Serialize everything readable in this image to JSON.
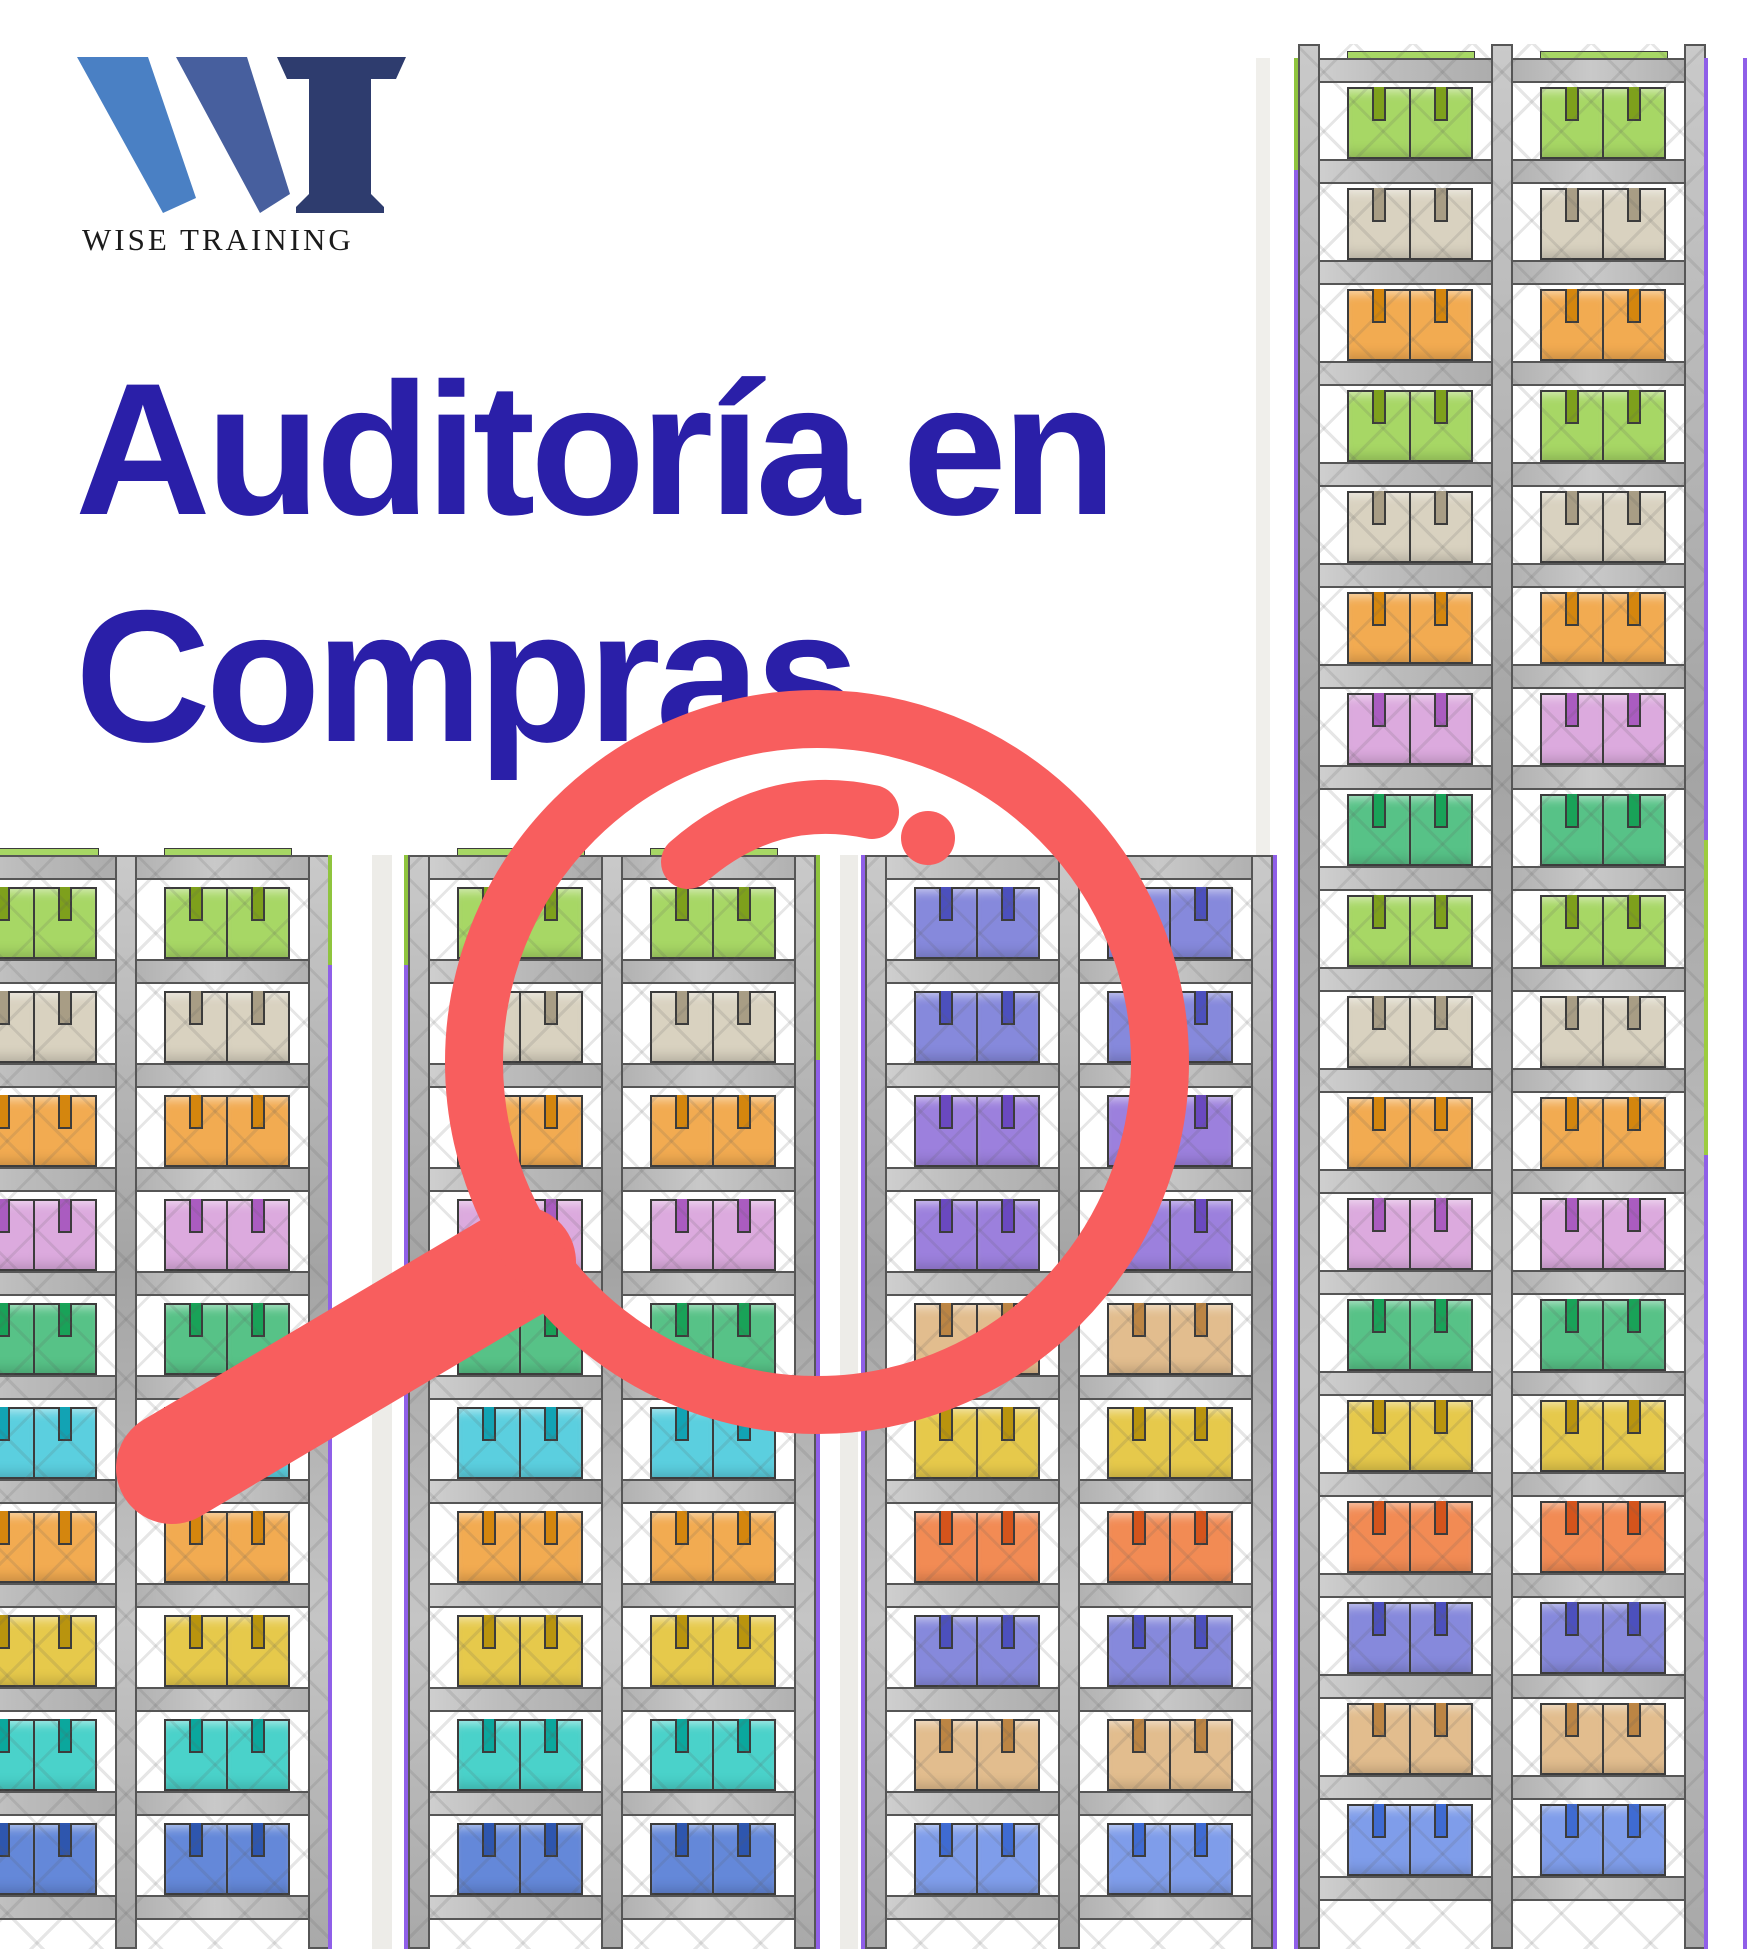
{
  "logo": {
    "brand": "WISE TRAINING",
    "colors": {
      "w1": "#4a80c4",
      "w2": "#475f9e",
      "t": "#2e3c6e",
      "text": "#1b1b1b"
    }
  },
  "title": {
    "line1": "Auditoría en",
    "line2": "Compras",
    "color": "#2a1fa8"
  },
  "palette": {
    "lightgreen": {
      "fill": "#a7d765",
      "strap": "#7ea01c"
    },
    "beige": {
      "fill": "#d9d2c0",
      "strap": "#a89d85"
    },
    "orange": {
      "fill": "#f2ab51",
      "strap": "#d4860e"
    },
    "lilac": {
      "fill": "#dcaade",
      "strap": "#aa5cc0"
    },
    "medgreen": {
      "fill": "#57c287",
      "strap": "#19a258"
    },
    "cyan": {
      "fill": "#5bcfdf",
      "strap": "#12a3b4"
    },
    "yellow": {
      "fill": "#e6c94b",
      "strap": "#b9940e"
    },
    "turquoise": {
      "fill": "#4ad2ca",
      "strap": "#0ba79d"
    },
    "blue": {
      "fill": "#6488d9",
      "strap": "#2e56ae"
    },
    "periwinkle": {
      "fill": "#8689dc",
      "strap": "#4c50bd"
    },
    "purple": {
      "fill": "#9c80dd",
      "strap": "#6a49c0"
    },
    "tan": {
      "fill": "#e2bd8e",
      "strap": "#bc8544"
    },
    "salmon": {
      "fill": "#f28b54",
      "strap": "#d4541c"
    },
    "lightblue": {
      "fill": "#7f9dea",
      "strap": "#3f6bd2"
    }
  },
  "rack_geometry": {
    "post_w": 22,
    "bay_w": 193,
    "bar_h": 25,
    "box_h": 72,
    "pair_w": 128,
    "pair_inset": 49
  },
  "racks": [
    {
      "id": "rack-left",
      "x": -78,
      "y": 855,
      "height": 1094,
      "bay_count": 2,
      "bar_count": 11,
      "pitch": 104,
      "bar_offset": 0,
      "top_sliver": "lightgreen",
      "rows": [
        "lightgreen",
        "beige",
        "orange",
        "lilac",
        "medgreen",
        "cyan",
        "orange",
        "yellow",
        "turquoise",
        "blue"
      ]
    },
    {
      "id": "rack-mid-left",
      "x": 408,
      "y": 855,
      "height": 1094,
      "bay_count": 2,
      "bar_count": 11,
      "pitch": 104,
      "bar_offset": 0,
      "top_sliver": "lightgreen",
      "rows": [
        "lightgreen",
        "beige",
        "orange",
        "lilac",
        "medgreen",
        "cyan",
        "orange",
        "yellow",
        "turquoise",
        "blue"
      ]
    },
    {
      "id": "rack-mid-right",
      "x": 865,
      "y": 855,
      "height": 1094,
      "bay_count": 2,
      "bar_count": 11,
      "pitch": 104,
      "bar_offset": 0,
      "top_sliver": null,
      "rows": [
        "periwinkle",
        "periwinkle",
        "purple",
        "purple",
        "tan",
        "yellow",
        "salmon",
        "periwinkle",
        "tan",
        "lightblue"
      ]
    },
    {
      "id": "rack-right-tall",
      "x": 1298,
      "y": 44,
      "height": 1905,
      "bay_count": 2,
      "bar_count": 19,
      "pitch": 101,
      "bar_offset": 14,
      "top_sliver": "lightgreen",
      "rows": [
        "lightgreen",
        "beige",
        "orange",
        "lightgreen",
        "beige",
        "orange",
        "lilac",
        "medgreen",
        "lightgreen",
        "beige",
        "orange",
        "lilac",
        "medgreen",
        "yellow",
        "salmon",
        "periwinkle",
        "tan",
        "lightblue"
      ]
    }
  ],
  "background_stripes": [
    {
      "x": 372,
      "y": 855,
      "w": 20,
      "h": 1094,
      "color": "#edece8"
    },
    {
      "x": 840,
      "y": 855,
      "w": 18,
      "h": 1094,
      "color": "#edece8"
    },
    {
      "x": 1256,
      "y": 58,
      "w": 14,
      "h": 1891,
      "color": "#f0efeb"
    }
  ],
  "edge_lines": [
    {
      "x": 328,
      "segments": [
        {
          "y1": 855,
          "y2": 965,
          "c": "#8fc43e"
        },
        {
          "y1": 965,
          "y2": 1949,
          "c": "#8f5fe8"
        }
      ]
    },
    {
      "x": 404,
      "segments": [
        {
          "y1": 855,
          "y2": 965,
          "c": "#8fc43e"
        },
        {
          "y1": 965,
          "y2": 1949,
          "c": "#8f5fe8"
        }
      ]
    },
    {
      "x": 816,
      "segments": [
        {
          "y1": 855,
          "y2": 1060,
          "c": "#8fc43e"
        },
        {
          "y1": 1060,
          "y2": 1949,
          "c": "#8f5fe8"
        }
      ]
    },
    {
      "x": 861,
      "segments": [
        {
          "y1": 855,
          "y2": 1949,
          "c": "#8f5fe8"
        }
      ]
    },
    {
      "x": 1273,
      "segments": [
        {
          "y1": 855,
          "y2": 1949,
          "c": "#8f5fe8"
        }
      ]
    },
    {
      "x": 1294,
      "segments": [
        {
          "y1": 58,
          "y2": 170,
          "c": "#8fc43e"
        },
        {
          "y1": 170,
          "y2": 1949,
          "c": "#8f5fe8"
        }
      ]
    },
    {
      "x": 1704,
      "segments": [
        {
          "y1": 58,
          "y2": 840,
          "c": "#8f5fe8"
        },
        {
          "y1": 840,
          "y2": 1155,
          "c": "#9ccc3f"
        },
        {
          "y1": 1155,
          "y2": 1949,
          "c": "#8f5fe8"
        }
      ]
    },
    {
      "x": 1743,
      "segments": [
        {
          "y1": 58,
          "y2": 1949,
          "c": "#8f5fe8"
        }
      ]
    }
  ],
  "magnifier": {
    "color": "#f85e5e",
    "ring": {
      "cx": 817,
      "cy": 1062,
      "r": 343,
      "stroke": 58
    },
    "handle": {
      "x1": 520,
      "y1": 1262,
      "x2": 172,
      "y2": 1468,
      "stroke": 112
    },
    "shine": {
      "d": "M 688 862 Q 770 790 872 812",
      "stroke": 54
    },
    "dot": {
      "cx": 928,
      "cy": 838,
      "r": 27
    }
  }
}
